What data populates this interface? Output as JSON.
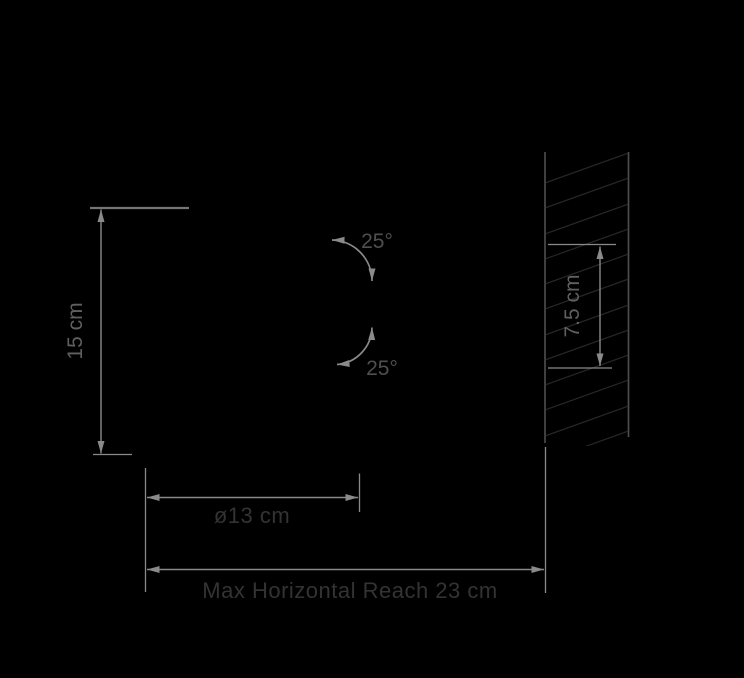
{
  "colors": {
    "bg": "#000000",
    "dim": "#8a8a8a",
    "extHeavy": "#757575",
    "wall": "#4f4f4f",
    "hatch": "#262626",
    "labelSide": "#606060",
    "labelAngle": "#4f4f4f",
    "labelDark": "#333333"
  },
  "diagram": {
    "height_label": "15 cm",
    "tilt_up_label": "25°",
    "tilt_down_label": "25°",
    "wall_plate_label": "7.5 cm",
    "diameter_label": "ø13 cm",
    "max_reach_label": "Max Horizontal Reach 23 cm"
  }
}
